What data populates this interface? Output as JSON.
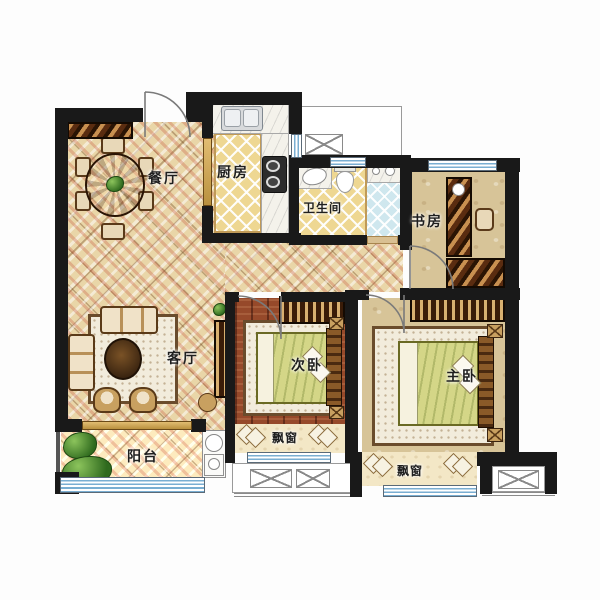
{
  "plan_title": "apartment-floor-plan",
  "rooms": {
    "dining": {
      "label": "餐厅"
    },
    "kitchen": {
      "label": "厨房"
    },
    "bathroom": {
      "label": "卫生间"
    },
    "study": {
      "label": "书房"
    },
    "living": {
      "label": "客厅"
    },
    "secondary_bedroom": {
      "label": "次卧"
    },
    "master_bedroom": {
      "label": "主卧"
    },
    "balcony": {
      "label": "阳台"
    },
    "bay_window_secondary": {
      "label": "飘窗"
    },
    "bay_window_master": {
      "label": "飘窗"
    }
  },
  "colors": {
    "wall": "#191919",
    "parquet_floor": "#e9d6a8",
    "tile_yellow": "#eed792",
    "tile_blue": "#cfe7ee",
    "wood_red": "#96492a",
    "floor_tan": "#d7c498",
    "window_blue": "#79aed2",
    "bay_cream": "#f3e7c6"
  }
}
